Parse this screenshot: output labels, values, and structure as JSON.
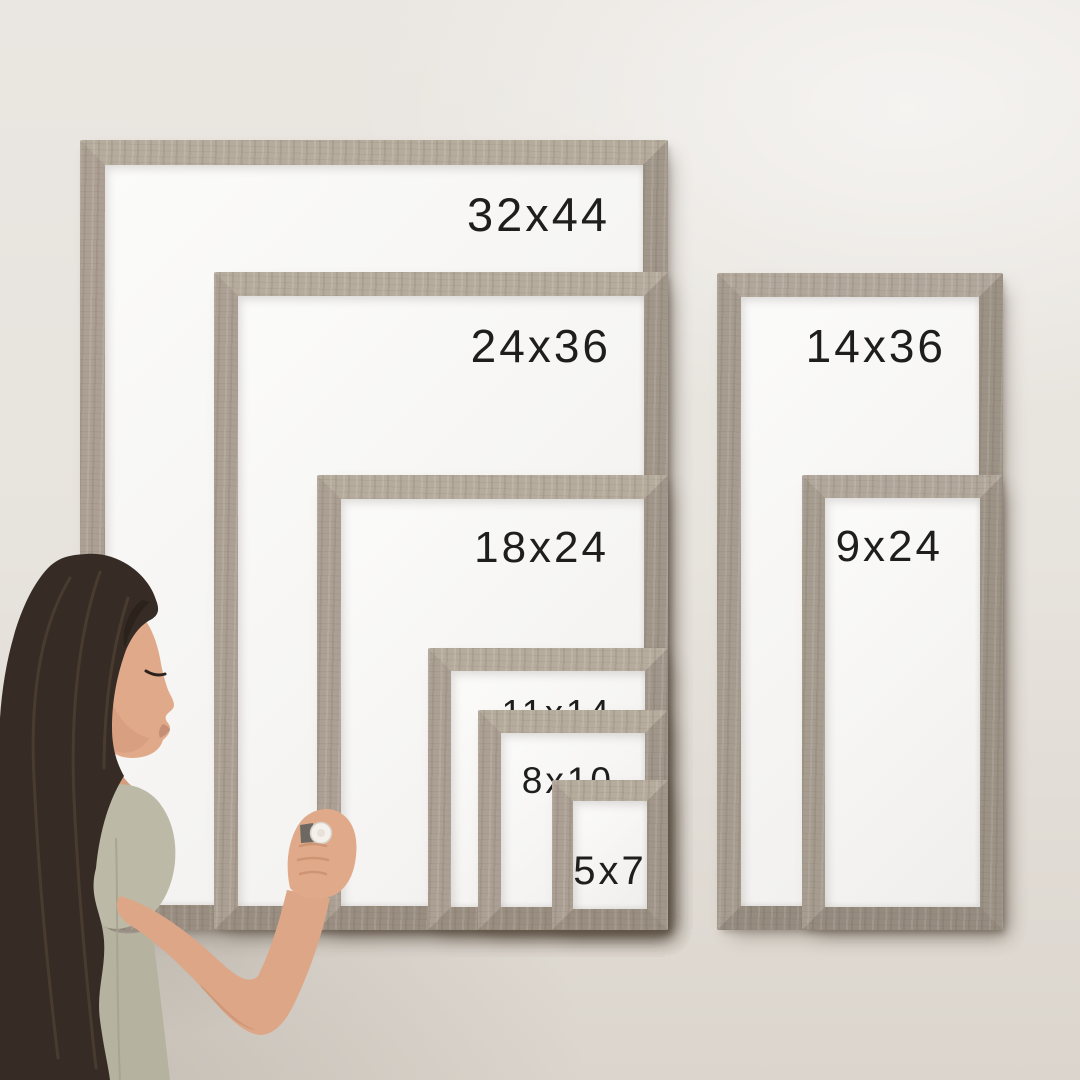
{
  "frames": {
    "left_group": [
      {
        "label": "32x44"
      },
      {
        "label": "24x36"
      },
      {
        "label": "18x24"
      },
      {
        "label": "11x14"
      },
      {
        "label": "8x10"
      },
      {
        "label": "5x7"
      }
    ],
    "right_group": [
      {
        "label": "14x36"
      },
      {
        "label": "9x24"
      }
    ]
  },
  "colors": {
    "wall": "#e7e3dd",
    "frame_wood": "#a79c8d",
    "whiteboard": "#f6f5f3",
    "label_text": "#1e1e1e",
    "hair": "#362c25",
    "skin": "#dca687",
    "shirt": "#bcbaa7",
    "marker_cap": "#f4f1ec"
  }
}
